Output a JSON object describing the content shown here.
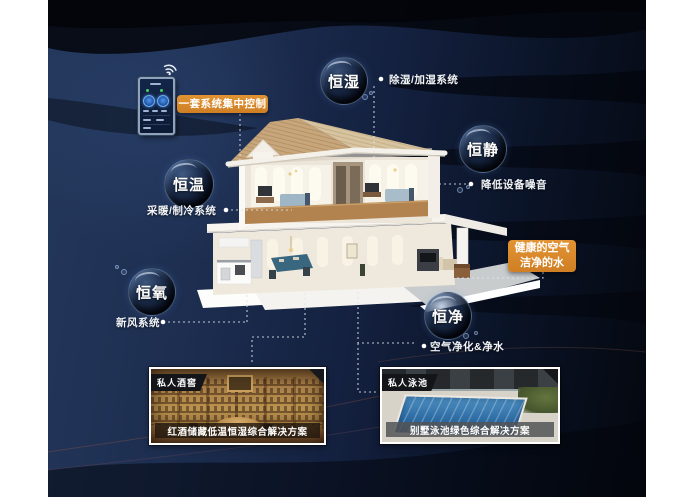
{
  "colors": {
    "accent_orange": "#DD8A2F",
    "background_navy": "#16233D",
    "connector_white": "#E8EEF5"
  },
  "control_panel": {
    "label": "一套系统集中控制"
  },
  "bubbles": [
    {
      "label": "恒湿",
      "note": "除湿/加湿系统"
    },
    {
      "label": "恒静",
      "note": "降低设备噪音"
    },
    {
      "label": "恒温",
      "note": "采暖/制冷系统"
    },
    {
      "label": "恒氧",
      "note": "新风系统"
    },
    {
      "label": "恒净",
      "note": "空气净化&净水"
    }
  ],
  "callout": {
    "line1": "健康的空气",
    "line2": "洁净的水"
  },
  "photos": [
    {
      "tag": "私人酒窖",
      "caption": "红酒储藏低温恒湿综合解决方案"
    },
    {
      "tag": "私人泳池",
      "caption": "别墅泳池绿色综合解决方案"
    }
  ]
}
